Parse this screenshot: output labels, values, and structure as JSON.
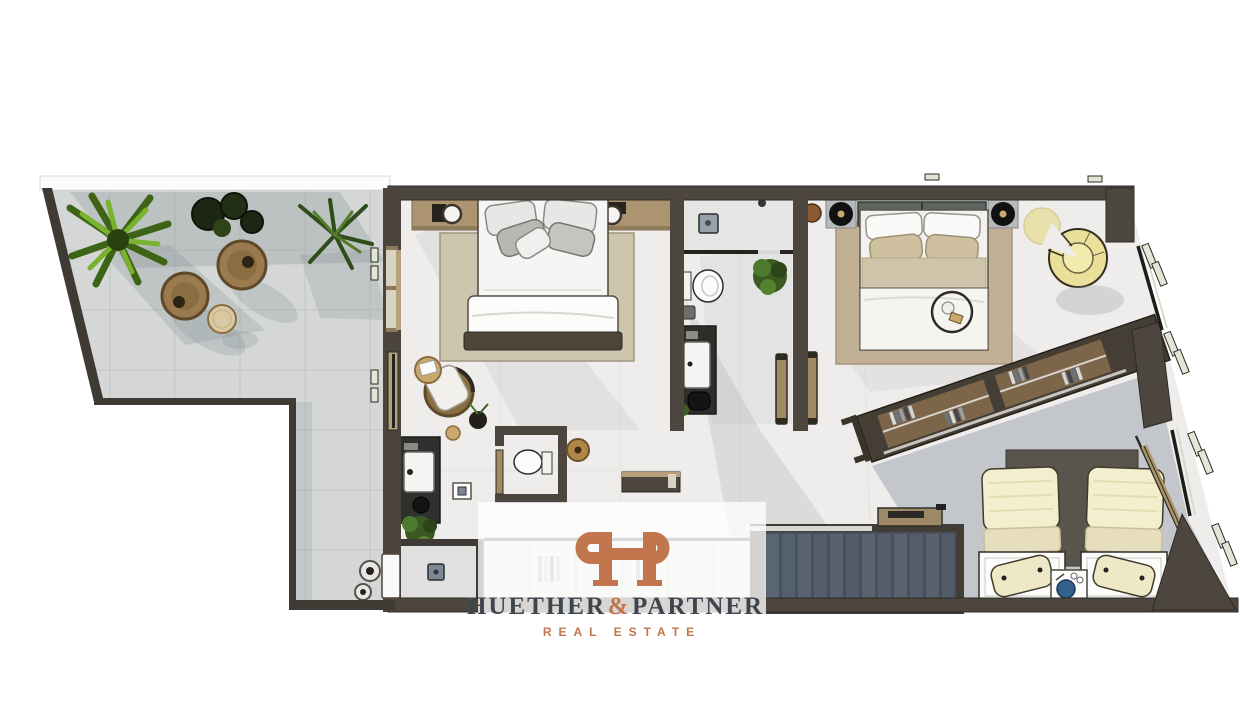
{
  "meta": {
    "width": 1240,
    "height": 720,
    "kind": "top-down 3D architectural floor-plan rendering",
    "background": "#ffffff"
  },
  "watermark": {
    "monogram": "HP",
    "wordmark": {
      "left": "HUETHER",
      "ampersand": "&",
      "right": "PARTNER"
    },
    "tagline": "REAL ESTATE",
    "panel_color": "#ffffff",
    "panel_opacity": 0.78,
    "accent_color": "#c1764e",
    "text_color": "#3f454d"
  },
  "palette": {
    "wall": "#4c463e",
    "wall_dark": "#3f3a33",
    "interior_floor": "#efedeb",
    "terrace_tile": "#d5d7d6",
    "shadow": "#8d949b",
    "wood_shelf": "#ac9470",
    "wood_light": "#b5a27b",
    "rug_bedroom1": "#cdc5ae",
    "rug_bedroom2": "#c2b094",
    "wicker": "#8a6e42",
    "side_table_wood": "#caa86e",
    "plant_green": "#5d8f23",
    "plant_dark": "#1c2613",
    "stair_step": "#55606d",
    "glass": "#d6dbcc",
    "bedding_cream": "#f3eecd",
    "headboard_sage": "#5e655e",
    "lounge_chair_yellow": "#ebe09a",
    "decor_blue": "#33618c"
  },
  "floorplan": {
    "rooms": [
      {
        "name": "roof-terrace",
        "items": [
          "palm-plant",
          "shrub-plants",
          "fern-plant",
          "wicker-lounge-chair",
          "wicker-lounge-chair",
          "round-side-table",
          "planter-pot",
          "planter-pot"
        ]
      },
      {
        "name": "bedroom-1",
        "items": [
          "double-bed",
          "headboard-shelf",
          "alarm-clock",
          "alarm-clock",
          "area-rug",
          "rattan-armchair",
          "round-side-table",
          "floor-plant"
        ]
      },
      {
        "name": "bathroom",
        "items": [
          "walk-in-shower",
          "toilet",
          "vanity-sink",
          "potted-plant"
        ]
      },
      {
        "name": "hallway",
        "items": [
          "guest-wc",
          "pouf",
          "wall-console",
          "open-door",
          "open-door"
        ]
      },
      {
        "name": "dressing-area",
        "items": [
          "vanity-sink",
          "floor-plant",
          "walk-in-shower",
          "built-in-wardrobe"
        ]
      },
      {
        "name": "bedroom-2",
        "items": [
          "double-bed",
          "record-player-nightstand",
          "record-player-nightstand",
          "storage-basket",
          "area-rug",
          "round-rug",
          "curved-lounge-chair",
          "decor-tray"
        ]
      },
      {
        "name": "walk-in-closet",
        "items": [
          "open-wardrobe-clothes-rail"
        ]
      },
      {
        "name": "staircase",
        "items": [
          "stair-steps",
          "wall-shelf"
        ]
      },
      {
        "name": "guest-bedroom",
        "items": [
          "single-bed",
          "single-bed",
          "headboard-panel",
          "bedside-table",
          "decor-sphere"
        ]
      }
    ],
    "features": [
      "panoramic-windows-on-diagonal-right-wall",
      "sliding-doors-to-terrace",
      "l-shaped-terrace"
    ]
  }
}
